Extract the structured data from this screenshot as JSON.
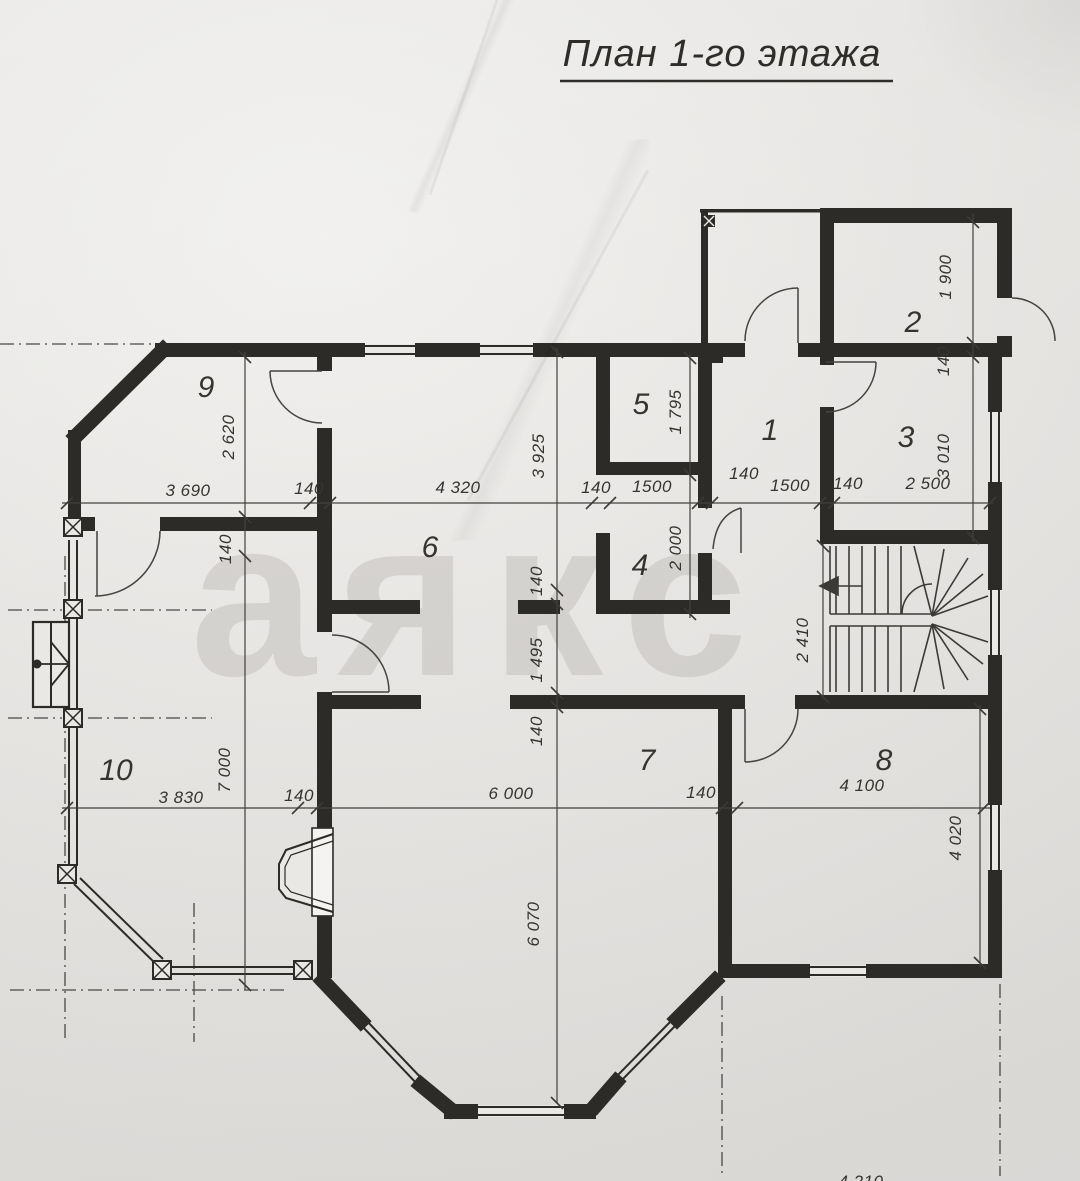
{
  "title": "План 1-го этажа",
  "watermark": "аякс",
  "rooms": {
    "r1": "1",
    "r2": "2",
    "r3": "3",
    "r4": "4",
    "r5": "5",
    "r6": "6",
    "r7": "7",
    "r8": "8",
    "r9": "9",
    "r10": "10"
  },
  "dims": {
    "chain_mid": [
      "3 690",
      "140",
      "4 320",
      "140",
      "1500",
      "140",
      "1500",
      "140",
      "2 500"
    ],
    "chain_low": [
      "3 830",
      "140",
      "6 000",
      "140",
      "4 100"
    ],
    "left_vert": [
      "2 620",
      "140",
      "7 000"
    ],
    "center_vert": [
      "3 925",
      "140",
      "1 495",
      "140",
      "6 070"
    ],
    "right_vert": [
      "1 900",
      "140",
      "3 010"
    ],
    "room5_vert": [
      "1 795",
      "2 000"
    ],
    "stair_height": "2 410",
    "room8_height": "4 020",
    "bottom_partial": "4 210"
  }
}
